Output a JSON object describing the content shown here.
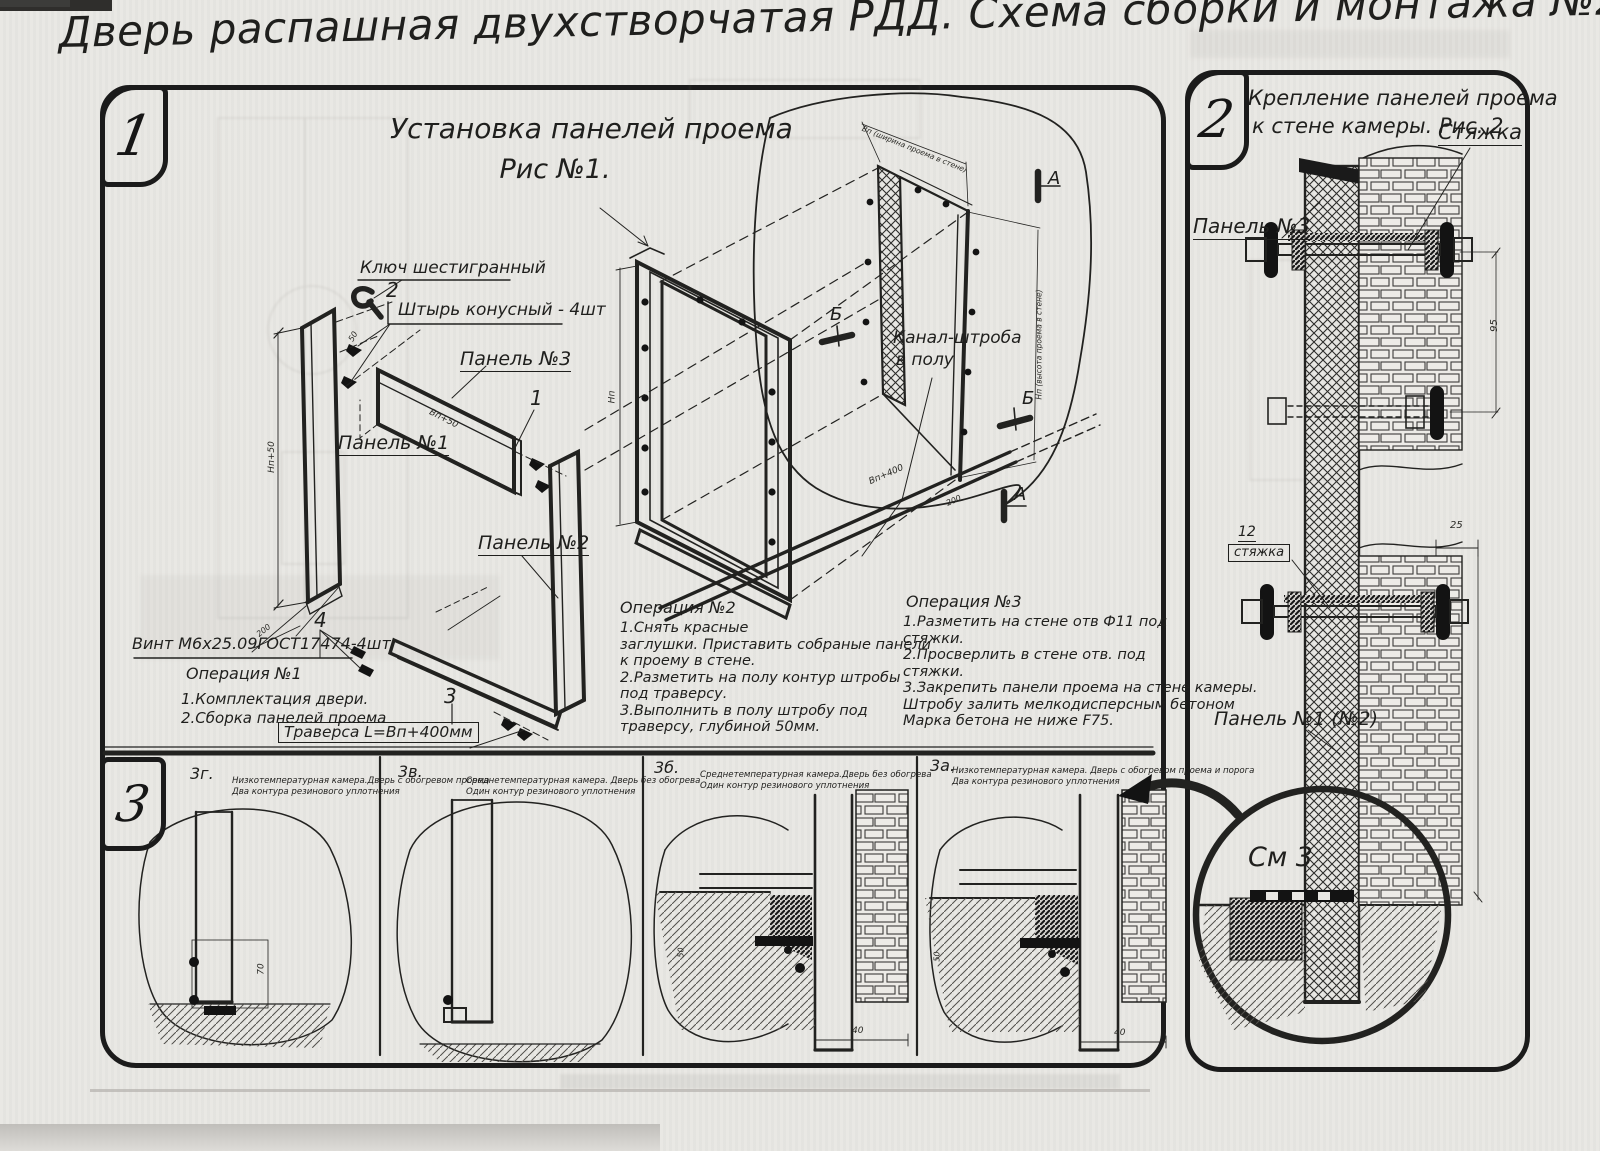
{
  "title": "Дверь распашная двухстворчатая РДД.  Схема сборки и монтажа №2",
  "sec1": {
    "marker": "1",
    "heading_line1": "Установка панелей проема",
    "heading_line2": "Рис №1.",
    "labels": {
      "hex_key": "Ключ шестигранный",
      "pin_num": "2",
      "pin": "Штырь конусный - 4шт",
      "panel3": "Панель №3",
      "num1": "1",
      "panel1": "Панель №1",
      "panel2": "Панель №2",
      "num4": "4",
      "screw": "Винт М6х25.09ГОСТ17474-4шт",
      "num3": "3",
      "traverse": "Траверса  L=Bп+400мм",
      "channel_line1": "Канал-штроба",
      "channel_line2": "в полу",
      "mark_a": "А",
      "mark_b": "Б"
    },
    "dims": {
      "np50": "Нп+50",
      "d200": "200",
      "vp50": "Вп+50",
      "np": "Нп",
      "vp400": "Вп+400",
      "wall_w": "Вп (ширина проема в стене)",
      "wall_h": "Нп (высота проема в стене)",
      "d50": "50"
    },
    "op1": {
      "title": "Операция №1",
      "lines": [
        "1.Комплектация двери.",
        "2.Сборка панелей проема"
      ]
    },
    "op2": {
      "title": "Операция №2",
      "lines": [
        "1.Снять красные",
        "заглушки. Приставить собраные панели",
        "к проему в стене.",
        "2.Разметить на полу контур штробы",
        "под траверсу.",
        "3.Выполнить в полу штробу под",
        "траверсу, глубиной 50мм."
      ]
    },
    "op3": {
      "title": "Операция №3",
      "lines": [
        "1.Разметить на стене отв Ф11 под",
        "стяжки.",
        "2.Просверлить в стене отв.  под",
        "стяжки.",
        "3.Закрепить панели проема на стене камеры.",
        "Штробу залить мелкодисперсным бетоном",
        "Марка бетона не ниже  F75."
      ]
    }
  },
  "sec2": {
    "marker": "2",
    "heading_line1": "Крепление панелей проема",
    "heading_line2": "к стене камеры. Рис. 2",
    "labels": {
      "styazhka": "Стяжка",
      "panel3": "Панель №3",
      "pos12": "12",
      "styazhka2": "стяжка",
      "panel12": "Панель №1 (№2)",
      "see3": "См 3"
    },
    "dims": {
      "d25": "25",
      "d95": "95"
    }
  },
  "sec3": {
    "marker": "3",
    "items": [
      {
        "label": "3г.",
        "caption1": "Низкотемпературная камера.Дверь с обогревом проема",
        "caption2": "Два контура резинового уплотнения"
      },
      {
        "label": "3в.",
        "caption1": "Среднетемпературная камера. Дверь без обогрева",
        "caption2": "Один контур резинового уплотнения"
      },
      {
        "label": "3б.",
        "caption1": "Среднетемпературная камера.Дверь без обогрева",
        "caption2": "Один контур резинового уплотнения"
      },
      {
        "label": "3а.",
        "caption1": "Низкотемпературная камера. Дверь с обогревом проема и порога",
        "caption2": "Два контура резинового уплотнения"
      }
    ],
    "dims": {
      "d70": "70",
      "d40": "40",
      "d50": "50"
    }
  }
}
